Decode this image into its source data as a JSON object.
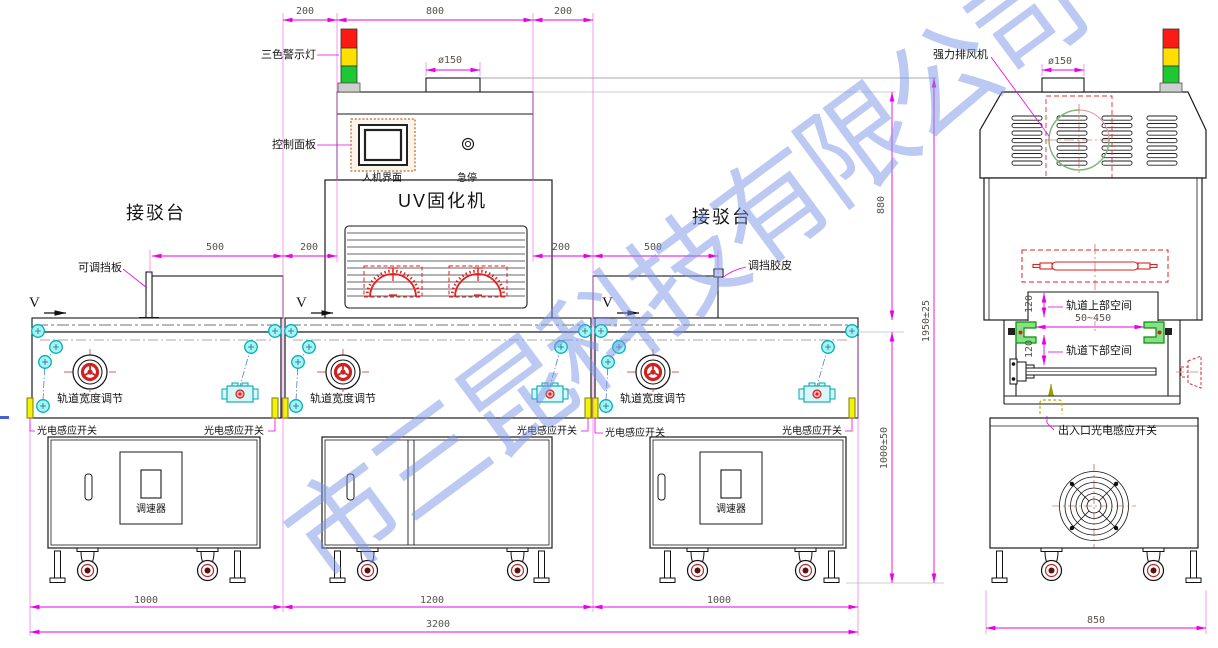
{
  "watermark": {
    "text": "市三昆科技有限公司"
  },
  "front_view": {
    "machine_label": "UV固化机",
    "labels": {
      "warning_light": "三色警示灯",
      "control_panel": "控制面板",
      "hmi": "人机界面",
      "estop": "急停",
      "transfer_tables": [
        "接驳台",
        "接驳台"
      ],
      "adjustable_baffle": "可调挡板",
      "baffle_rubber": "调挡胶皮",
      "track_width": [
        "轨道宽度调节",
        "轨道宽度调节",
        "轨道宽度调节"
      ],
      "photo_switch": [
        "光电感应开关",
        "光电感应开关",
        "光电感应开关",
        "光电感应开关",
        "光电感应开关"
      ],
      "speed_controller": [
        "调速器",
        "调速器"
      ],
      "direction": [
        "V",
        "V",
        "V"
      ]
    },
    "dims": {
      "top": [
        "200",
        "800",
        "200"
      ],
      "duct": "ø150",
      "left_hood": [
        "500",
        "200"
      ],
      "right_hood": [
        "200",
        "500"
      ],
      "height_upper": "880",
      "height_total": "1950±25",
      "height_table": "1000±50",
      "bottom": [
        "1000",
        "1200",
        "1000"
      ],
      "total_width": "3200"
    }
  },
  "side_view": {
    "labels": {
      "exhaust_fan": "强力排风机",
      "track_upper_space": "轨道上部空间",
      "track_lower_space": "轨道下部空间",
      "io_photo_switch": "出入口光电感应开关"
    },
    "dims": {
      "duct": "ø150",
      "upper_space": "120",
      "track_width_range": "50~450",
      "lower_space": "120",
      "base_width": "850"
    }
  },
  "colors": {
    "dimension_magenta": "#e800e8",
    "warning_red": "#fb1b14",
    "warning_yellow": "#ffdf00",
    "warning_green": "#1ec832",
    "machine_line": "#1a1a1a",
    "cyan_part": "#00b6c0",
    "rail_green": "#069006",
    "lamp_red": "#dd2222",
    "watermark_blue": "#7b96e8"
  }
}
